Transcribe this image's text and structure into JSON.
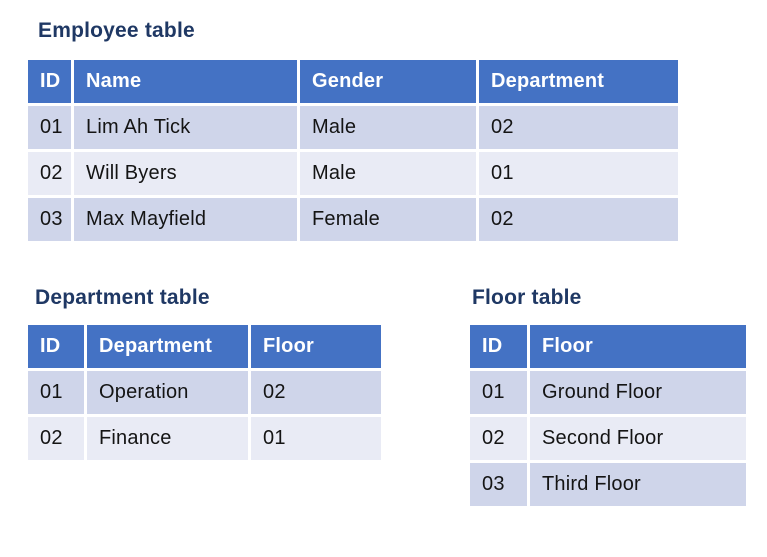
{
  "colors": {
    "header_bg": "#4472C4",
    "row_odd": "#CFD5EA",
    "row_even": "#E9EBF5",
    "title_color": "#1F3864",
    "header_text": "#FFFFFF",
    "cell_text": "#141414",
    "page_bg": "#FFFFFF"
  },
  "tables": {
    "employee": {
      "title": "Employee table",
      "columns": [
        "ID",
        "Name",
        "Gender",
        "Department"
      ],
      "rows": [
        [
          "01",
          "Lim Ah Tick",
          "Male",
          "02"
        ],
        [
          "02",
          "Will Byers",
          "Male",
          "01"
        ],
        [
          "03",
          "Max Mayfield",
          "Female",
          "02"
        ]
      ]
    },
    "department": {
      "title": "Department table",
      "columns": [
        "ID",
        "Department",
        "Floor"
      ],
      "rows": [
        [
          "01",
          "Operation",
          "02"
        ],
        [
          "02",
          "Finance",
          "01"
        ]
      ]
    },
    "floor": {
      "title": "Floor table",
      "columns": [
        "ID",
        "Floor"
      ],
      "rows": [
        [
          "01",
          "Ground Floor"
        ],
        [
          "02",
          "Second Floor"
        ],
        [
          "03",
          "Third Floor"
        ]
      ]
    }
  }
}
